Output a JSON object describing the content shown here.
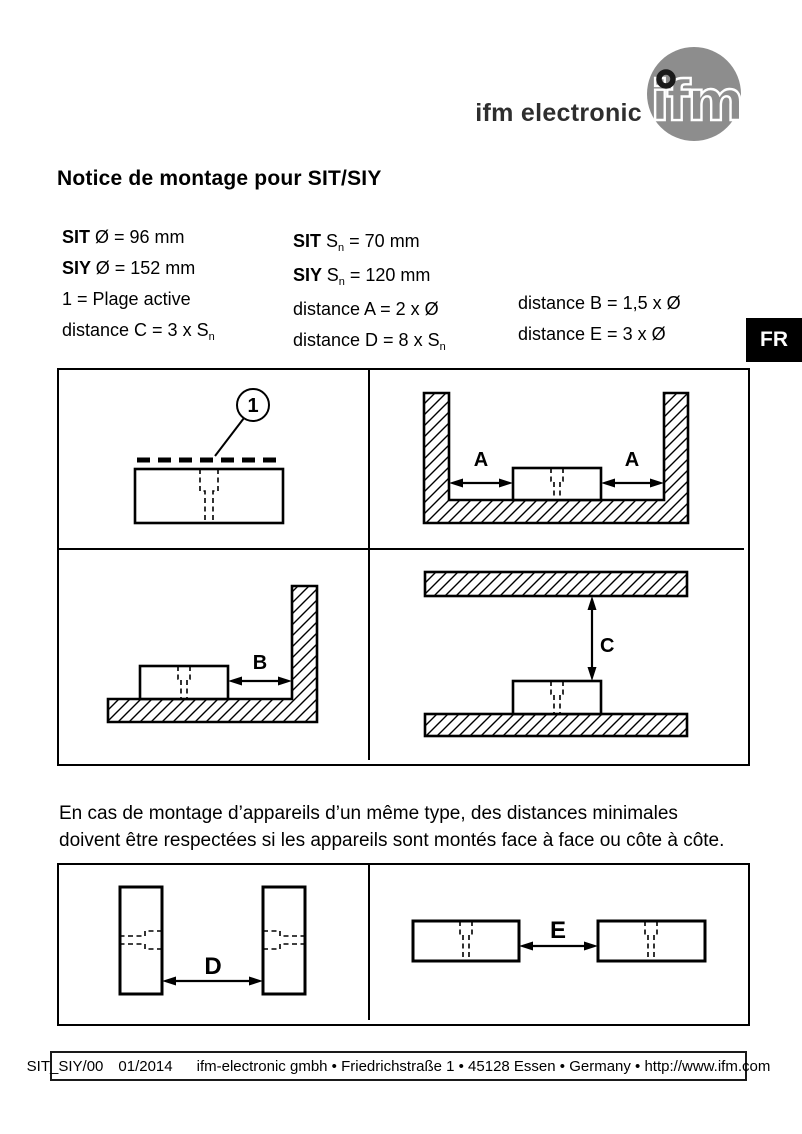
{
  "header": {
    "brand_text": "ifm electronic",
    "logo_letters": "ifm",
    "logo_circle_color": "#8d8d8d"
  },
  "language_tab": "FR",
  "title": "Notice de montage pour SIT/SIY",
  "specs": {
    "columns": [
      [
        [
          {
            "t": "SIT ",
            "s": "b"
          },
          {
            "t": "Ø = 96 mm"
          }
        ],
        [
          {
            "t": "SIY ",
            "s": "b"
          },
          {
            "t": "Ø = 152 mm"
          }
        ],
        [
          {
            "t": "1 = Plage active"
          }
        ],
        [
          {
            "t": "distance C = 3 x S"
          },
          {
            "t": "n",
            "s": "sub"
          }
        ]
      ],
      [
        [
          {
            "t": "SIT ",
            "s": "b"
          },
          {
            "t": "S"
          },
          {
            "t": "n",
            "s": "sub"
          },
          {
            "t": " = 70 mm"
          }
        ],
        [
          {
            "t": "SIY ",
            "s": "b"
          },
          {
            "t": "S"
          },
          {
            "t": "n",
            "s": "sub"
          },
          {
            "t": " = 120 mm"
          }
        ],
        [
          {
            "t": "distance A = 2 x Ø"
          }
        ],
        [
          {
            "t": "distance D = 8 x S"
          },
          {
            "t": "n",
            "s": "sub"
          }
        ]
      ],
      [
        [
          {
            "t": "distance B = 1,5 x Ø"
          }
        ],
        [
          {
            "t": "distance E = 3 x Ø"
          }
        ]
      ]
    ]
  },
  "diagram_labels": {
    "callout": "1",
    "a": "A",
    "b": "B",
    "c": "C",
    "d": "D",
    "e": "E"
  },
  "note": "En cas de montage d’appareils d’un même type, des distances minimales doivent être respectées si les appareils sont montés face à face ou côte à côte.",
  "footer": {
    "doc_code": "SIT_SIY/00",
    "date": "01/2014",
    "address": "ifm-electronic gmbh • Friedrichstraße 1 • 45128 Essen • Germany • http://www.ifm.com"
  }
}
